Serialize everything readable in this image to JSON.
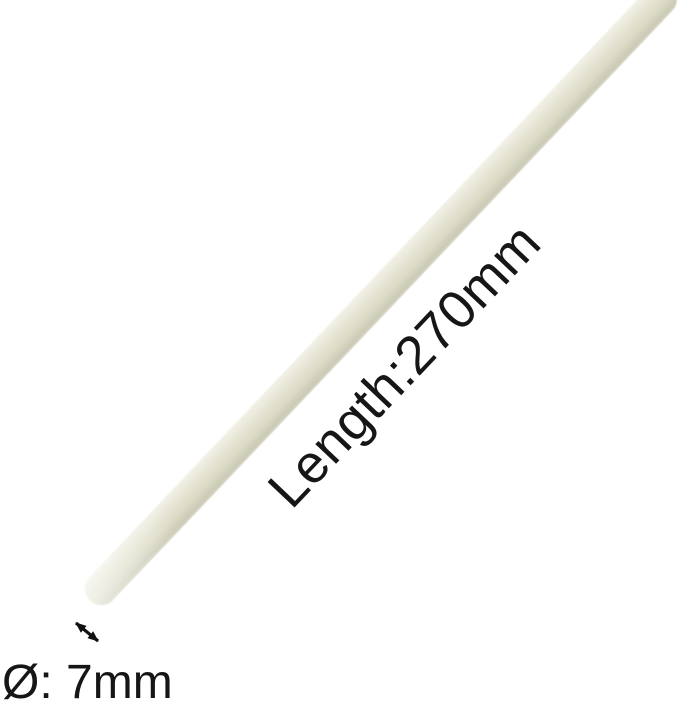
{
  "product": {
    "object_name": "glue-stick",
    "length_label": "Length:270mm",
    "diameter_label": "Ø: 7mm",
    "colors": {
      "background": "#ffffff",
      "annotation_text": "#161616",
      "arrow": "#111111",
      "stick_highlight": "#f2f1e7",
      "stick_mid_light": "#e6e5d4",
      "stick_mid": "#dcdbc6",
      "stick_shadow": "#cbcab6",
      "stick_edge": "#d6d5c4"
    }
  }
}
